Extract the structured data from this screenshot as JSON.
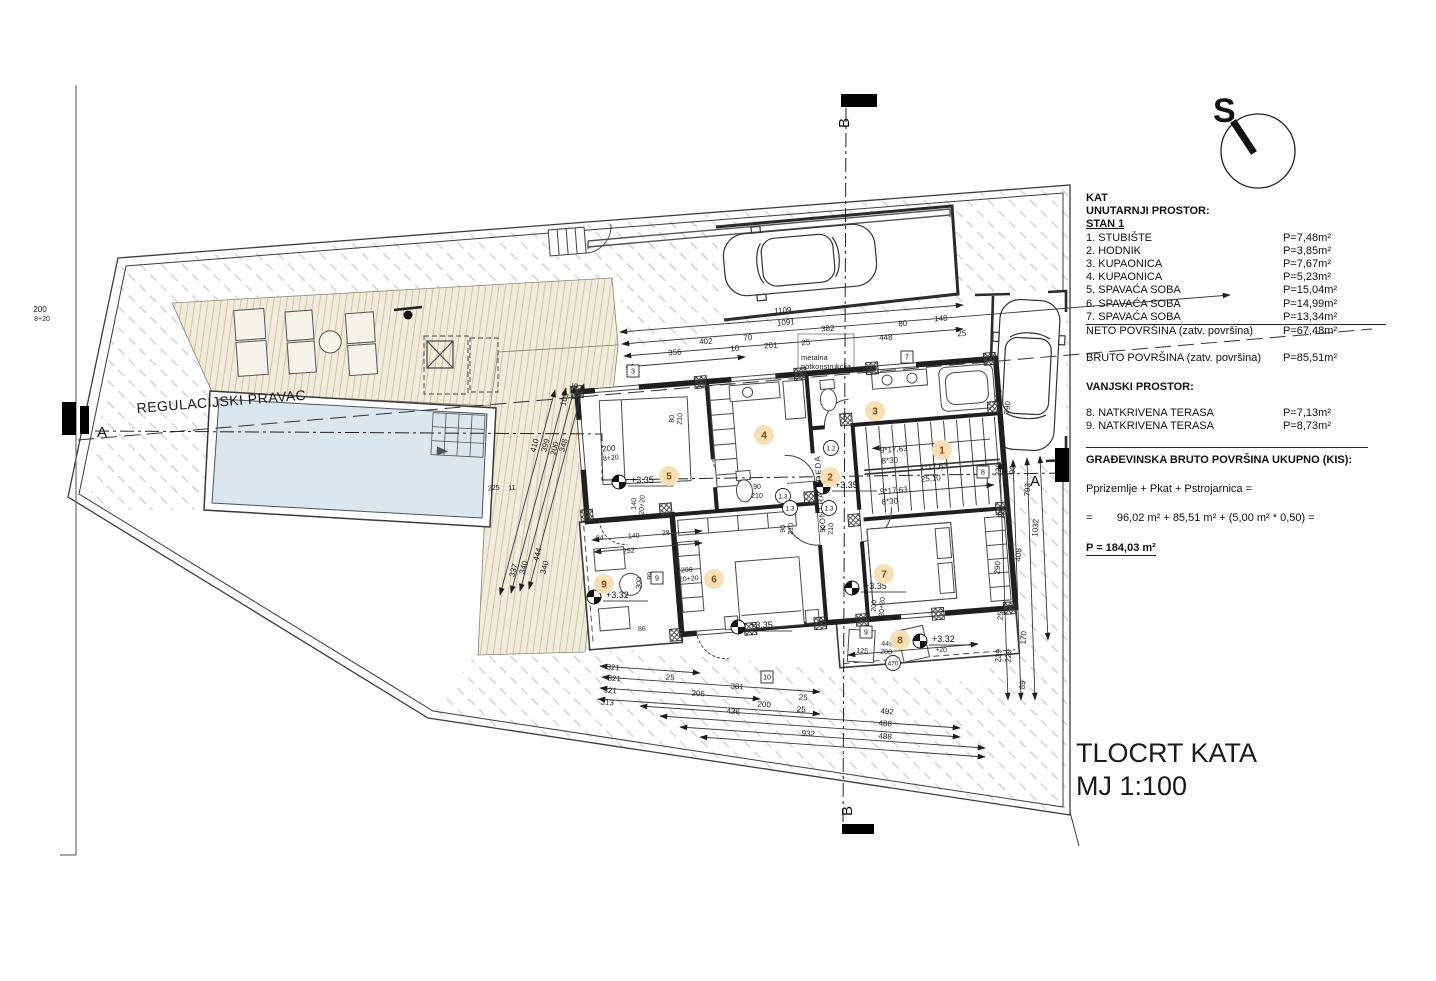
{
  "colors": {
    "badge_bg": "#f7dfb6",
    "badge_text": "#8d4a10",
    "pool_water": "#dce6ee",
    "deck_fill": "#f2ebdb",
    "hatch_line": "#d3d6d9",
    "line_dark": "#2b2b2b"
  },
  "compass": {
    "letter": "S"
  },
  "sections": {
    "a": "A",
    "b": "B"
  },
  "regulation_label": "REGULACIJSKI PRAVAC",
  "canopy": {
    "line1": "metalna",
    "line2": "potkonstrukcija"
  },
  "kontra_greda": "KONTRA GREDA",
  "title_block": {
    "line1": "TLOCRT KATA",
    "line2": "MJ 1:100"
  },
  "legend": {
    "floor": "KAT",
    "interior_header": "UNUTARNJI PROSTOR:",
    "unit": "STAN 1",
    "rooms": [
      {
        "name": "1. STUBIŠTE",
        "area": "P=7,48m²"
      },
      {
        "name": "2. HODNIK",
        "area": "P=3,85m²"
      },
      {
        "name": "3. KUPAONICA",
        "area": "P=7,67m²"
      },
      {
        "name": "4. KUPAONICA",
        "area": "P=5,23m²"
      },
      {
        "name": "5. SPAVAĆA SOBA",
        "area": "P=15,04m²"
      },
      {
        "name": "6. SPAVAĆA SOBA",
        "area": "P=14,99m²"
      },
      {
        "name": "7. SPAVAĆA SOBA",
        "area": "P=13,34m²"
      }
    ],
    "neto": {
      "name": "NETO POVRŠINA (zatv. površina)",
      "area": "P=67,48m²"
    },
    "bruto": {
      "name": "BRUTO POVRŠINA (zatv. površina)",
      "area": "P=85,51m²"
    },
    "exterior_header": "VANJSKI PROSTOR:",
    "exterior_rooms": [
      {
        "name": "8. NATKRIVENA TERASA",
        "area": "P=7,13m²"
      },
      {
        "name": "9. NATKRIVENA TERASA",
        "area": "P=8,73m²"
      }
    ],
    "total_header": "GRAĐEVINSKA BRUTO POVRŠINA UKUPNO (KIS):",
    "total_formula1": "Pprizemlje + Pkat + Pstrojarnica =",
    "total_formula2": "=        96,02 m² + 85,51 m² + (5,00 m² * 0,50) =",
    "total": "P = 184,03 m²"
  },
  "stairs": {
    "run_upper_a": "9*17,63",
    "run_upper_b": "8*30",
    "mid_a": "1*17,63",
    "mid_b": "25,10",
    "run_lower_a": "9*17,63",
    "run_lower_b": "8*30"
  },
  "room_badges": [
    {
      "n": "1",
      "x": 942,
      "y": 450
    },
    {
      "n": "2",
      "x": 830,
      "y": 477
    },
    {
      "n": "3",
      "x": 875,
      "y": 411
    },
    {
      "n": "4",
      "x": 764,
      "y": 435
    },
    {
      "n": "5",
      "x": 669,
      "y": 476
    },
    {
      "n": "6",
      "x": 714,
      "y": 579
    },
    {
      "n": "7",
      "x": 884,
      "y": 574
    },
    {
      "n": "8",
      "x": 900,
      "y": 640
    },
    {
      "n": "9",
      "x": 604,
      "y": 584
    }
  ],
  "elevation_markers": [
    {
      "t": "+3.35",
      "x": 619,
      "y": 482
    },
    {
      "t": "+3.35",
      "x": 823,
      "y": 487
    },
    {
      "t": "+3.35",
      "x": 852,
      "y": 588
    },
    {
      "t": "+3.35",
      "x": 738,
      "y": 627
    },
    {
      "t": "+3.32",
      "x": 594,
      "y": 597
    },
    {
      "t": "+3.32",
      "x": 920,
      "y": 641
    }
  ],
  "box_tags": [
    {
      "t": "3",
      "x": 633,
      "y": 371
    },
    {
      "t": "7",
      "x": 907,
      "y": 357
    },
    {
      "t": "9",
      "x": 866,
      "y": 632
    },
    {
      "t": "10",
      "x": 767,
      "y": 677
    },
    {
      "t": "9",
      "x": 657,
      "y": 578
    },
    {
      "t": "8",
      "x": 983,
      "y": 472
    }
  ],
  "circle_tags": [
    {
      "t": "1.3",
      "x": 783,
      "y": 496
    },
    {
      "t": "1.3",
      "x": 790,
      "y": 508
    },
    {
      "t": "1.3",
      "x": 829,
      "y": 508
    },
    {
      "t": "1.2",
      "x": 831,
      "y": 448
    },
    {
      "t": "470",
      "x": 893,
      "y": 663
    }
  ],
  "dim_labels": [
    {
      "t": "1109",
      "x": 783,
      "y": 313,
      "r": -4.5
    },
    {
      "t": "1091",
      "x": 786,
      "y": 325,
      "r": -4.5
    },
    {
      "t": "382",
      "x": 828,
      "y": 331,
      "r": -4.5
    },
    {
      "t": "80",
      "x": 903,
      "y": 326,
      "r": -4.5
    },
    {
      "t": "148",
      "x": 941,
      "y": 321,
      "r": -4.5
    },
    {
      "t": "25",
      "x": 962,
      "y": 336,
      "r": -4.5
    },
    {
      "t": "402",
      "x": 706,
      "y": 344,
      "r": -4.5
    },
    {
      "t": "70",
      "x": 748,
      "y": 340,
      "r": -4.5
    },
    {
      "t": "201",
      "x": 771,
      "y": 348,
      "r": -4.5
    },
    {
      "t": "25",
      "x": 806,
      "y": 345,
      "r": -4.5
    },
    {
      "t": "448",
      "x": 886,
      "y": 340,
      "r": -4.5
    },
    {
      "t": "356",
      "x": 675,
      "y": 355,
      "r": -4.5
    },
    {
      "t": "10",
      "x": 735,
      "y": 351,
      "r": -4.5
    },
    {
      "t": "321",
      "x": 613,
      "y": 670,
      "r": 4
    },
    {
      "t": "321",
      "x": 614,
      "y": 681,
      "r": 4
    },
    {
      "t": "25",
      "x": 670,
      "y": 680,
      "r": 4
    },
    {
      "t": "321",
      "x": 610,
      "y": 693,
      "r": 4
    },
    {
      "t": "206",
      "x": 698,
      "y": 696,
      "r": 4
    },
    {
      "t": "381",
      "x": 737,
      "y": 689,
      "r": 4
    },
    {
      "t": "313",
      "x": 607,
      "y": 705,
      "r": 4
    },
    {
      "t": "200",
      "x": 764,
      "y": 707,
      "r": 4
    },
    {
      "t": "25",
      "x": 803,
      "y": 700,
      "r": 4
    },
    {
      "t": "436",
      "x": 733,
      "y": 714,
      "r": 4
    },
    {
      "t": "25",
      "x": 801,
      "y": 712,
      "r": 4
    },
    {
      "t": "492",
      "x": 887,
      "y": 714,
      "r": 4
    },
    {
      "t": "488",
      "x": 885,
      "y": 726,
      "r": 4
    },
    {
      "t": "932",
      "x": 808,
      "y": 736,
      "r": 4
    },
    {
      "t": "488",
      "x": 885,
      "y": 739,
      "r": 4
    },
    {
      "t": "105",
      "x": 567,
      "y": 400,
      "r": -75
    },
    {
      "t": "25",
      "x": 577,
      "y": 388,
      "r": -75
    },
    {
      "t": "410",
      "x": 537,
      "y": 446,
      "r": -75
    },
    {
      "t": "399",
      "x": 548,
      "y": 446,
      "r": -75
    },
    {
      "t": "200",
      "x": 557,
      "y": 449,
      "r": -75
    },
    {
      "t": "348",
      "x": 566,
      "y": 446,
      "r": -75
    },
    {
      "t": "337",
      "x": 516,
      "y": 571,
      "r": -75
    },
    {
      "t": "340",
      "x": 526,
      "y": 568,
      "r": -75
    },
    {
      "t": "444",
      "x": 540,
      "y": 555,
      "r": -75
    },
    {
      "t": "340",
      "x": 547,
      "y": 568,
      "r": -75
    },
    {
      "t": "220",
      "x": 1001,
      "y": 470,
      "r": -86
    },
    {
      "t": "90",
      "x": 1015,
      "y": 470,
      "r": -86
    },
    {
      "t": "793",
      "x": 1030,
      "y": 490,
      "r": -86
    },
    {
      "t": "25",
      "x": 1004,
      "y": 514,
      "r": -86
    },
    {
      "t": "1032",
      "x": 1038,
      "y": 528,
      "r": -86
    },
    {
      "t": "408",
      "x": 1021,
      "y": 555,
      "r": -86
    },
    {
      "t": "290",
      "x": 1000,
      "y": 568,
      "r": -86
    },
    {
      "t": "25",
      "x": 1003,
      "y": 616,
      "r": -86
    },
    {
      "t": "170",
      "x": 1026,
      "y": 638,
      "r": -86
    },
    {
      "t": "239",
      "x": 1001,
      "y": 656,
      "r": -86
    },
    {
      "t": "229",
      "x": 1011,
      "y": 656,
      "r": -86
    },
    {
      "t": "89",
      "x": 1025,
      "y": 685,
      "r": -86
    },
    {
      "t": "181",
      "x": 1001,
      "y": 396,
      "r": -86
    },
    {
      "t": "790",
      "x": 1010,
      "y": 408,
      "r": -86
    },
    {
      "t": "200",
      "x": 609,
      "y": 451,
      "r": -4.5
    },
    {
      "t": "8+20",
      "x": 611,
      "y": 460,
      "r": -4.5,
      "s": 7
    },
    {
      "t": "200",
      "x": 40,
      "y": 312,
      "r": 0
    },
    {
      "t": "8+20",
      "x": 42,
      "y": 321,
      "r": 0,
      "s": 7
    },
    {
      "t": "84",
      "x": 600,
      "y": 540,
      "r": -4.5,
      "s": 7
    },
    {
      "t": "140",
      "x": 634,
      "y": 538,
      "r": -4.5,
      "s": 7
    },
    {
      "t": "28",
      "x": 666,
      "y": 535,
      "r": -4.5,
      "s": 7
    },
    {
      "t": "252",
      "x": 629,
      "y": 553,
      "r": -4.5,
      "s": 7
    },
    {
      "t": "86",
      "x": 642,
      "y": 631,
      "r": -4.5,
      "s": 7
    },
    {
      "t": "225",
      "x": 494,
      "y": 490,
      "r": -4.5,
      "s": 7
    },
    {
      "t": "11",
      "x": 512,
      "y": 490,
      "r": -4.5,
      "s": 7
    },
    {
      "t": "445",
      "x": 887,
      "y": 646,
      "r": 4,
      "s": 7
    },
    {
      "t": "125",
      "x": 862,
      "y": 653,
      "r": 4,
      "s": 7
    },
    {
      "t": "200",
      "x": 886,
      "y": 654,
      "r": 4,
      "s": 7
    },
    {
      "t": "+20",
      "x": 941,
      "y": 652,
      "r": 4,
      "s": 7
    },
    {
      "t": "90",
      "x": 757,
      "y": 489,
      "r": 0,
      "s": 7
    },
    {
      "t": "210",
      "x": 757,
      "y": 498,
      "r": 0,
      "s": 7
    },
    {
      "t": "99",
      "x": 652,
      "y": 576,
      "r": -86,
      "s": 7
    },
    {
      "t": "300",
      "x": 641,
      "y": 583,
      "r": -86,
      "s": 7
    },
    {
      "t": "80",
      "x": 674,
      "y": 419,
      "r": -86,
      "s": 7
    },
    {
      "t": "210",
      "x": 682,
      "y": 419,
      "r": -86,
      "s": 7
    },
    {
      "t": "90",
      "x": 785,
      "y": 529,
      "r": -86,
      "s": 7
    },
    {
      "t": "210",
      "x": 793,
      "y": 529,
      "r": -86,
      "s": 7
    },
    {
      "t": "90",
      "x": 825,
      "y": 529,
      "r": -86,
      "s": 7
    },
    {
      "t": "210",
      "x": 833,
      "y": 529,
      "r": -86,
      "s": 7
    },
    {
      "t": "140",
      "x": 636,
      "y": 504,
      "r": -86,
      "s": 7
    },
    {
      "t": "220+20",
      "x": 644,
      "y": 507,
      "r": -86,
      "s": 7
    },
    {
      "t": "200",
      "x": 876,
      "y": 606,
      "r": -86,
      "s": 7
    },
    {
      "t": "220+20",
      "x": 884,
      "y": 609,
      "r": -86,
      "s": 7
    },
    {
      "t": "200",
      "x": 687,
      "y": 572,
      "r": -4.5,
      "s": 7
    },
    {
      "t": "220+20",
      "x": 687,
      "y": 581,
      "r": -4.5,
      "s": 7
    },
    {
      "t": "9*17,63",
      "x": 894,
      "y": 452,
      "r": -4.5
    },
    {
      "t": "8*30",
      "x": 890,
      "y": 463,
      "r": -4.5
    },
    {
      "t": "1*17,63",
      "x": 934,
      "y": 469,
      "r": -4.5
    },
    {
      "t": "25,10",
      "x": 931,
      "y": 481,
      "r": -4.5
    },
    {
      "t": "9*17,63",
      "x": 894,
      "y": 493,
      "r": -4.5
    },
    {
      "t": "8*30",
      "x": 890,
      "y": 504,
      "r": -4.5
    }
  ]
}
